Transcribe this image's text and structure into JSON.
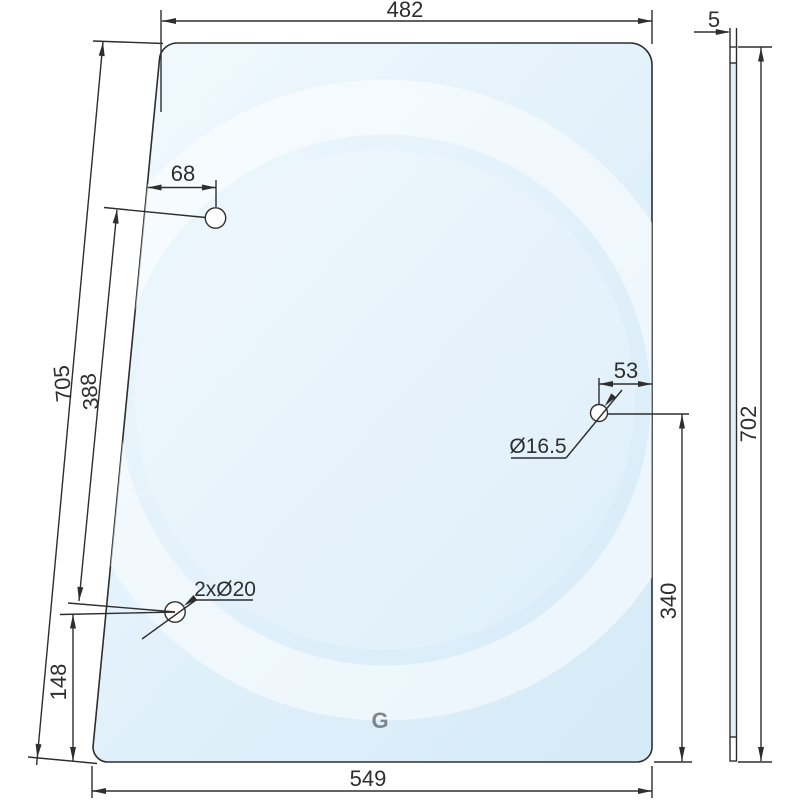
{
  "drawing": {
    "front_view": {
      "width_top": "482",
      "width_bottom": "549",
      "left_edge_length": "705",
      "left_hole_pitch": "388",
      "bottom_hole_to_edge": "148",
      "top_hole_offset_x": "68",
      "left_holes_label": "2xØ20"
    },
    "right_hole": {
      "offset_from_edge": "53",
      "offset_from_bottom": "340",
      "diameter_label": "Ø16.5"
    },
    "side_view": {
      "thickness": "5",
      "height": "702"
    },
    "watermark_letter": "G",
    "colors": {
      "line": "#2e2e2e",
      "glass_light": "#f2fafe",
      "glass_mid": "#e4f2fb",
      "glass_dark": "#d6ebf8",
      "watermark": "#ffffff"
    }
  }
}
